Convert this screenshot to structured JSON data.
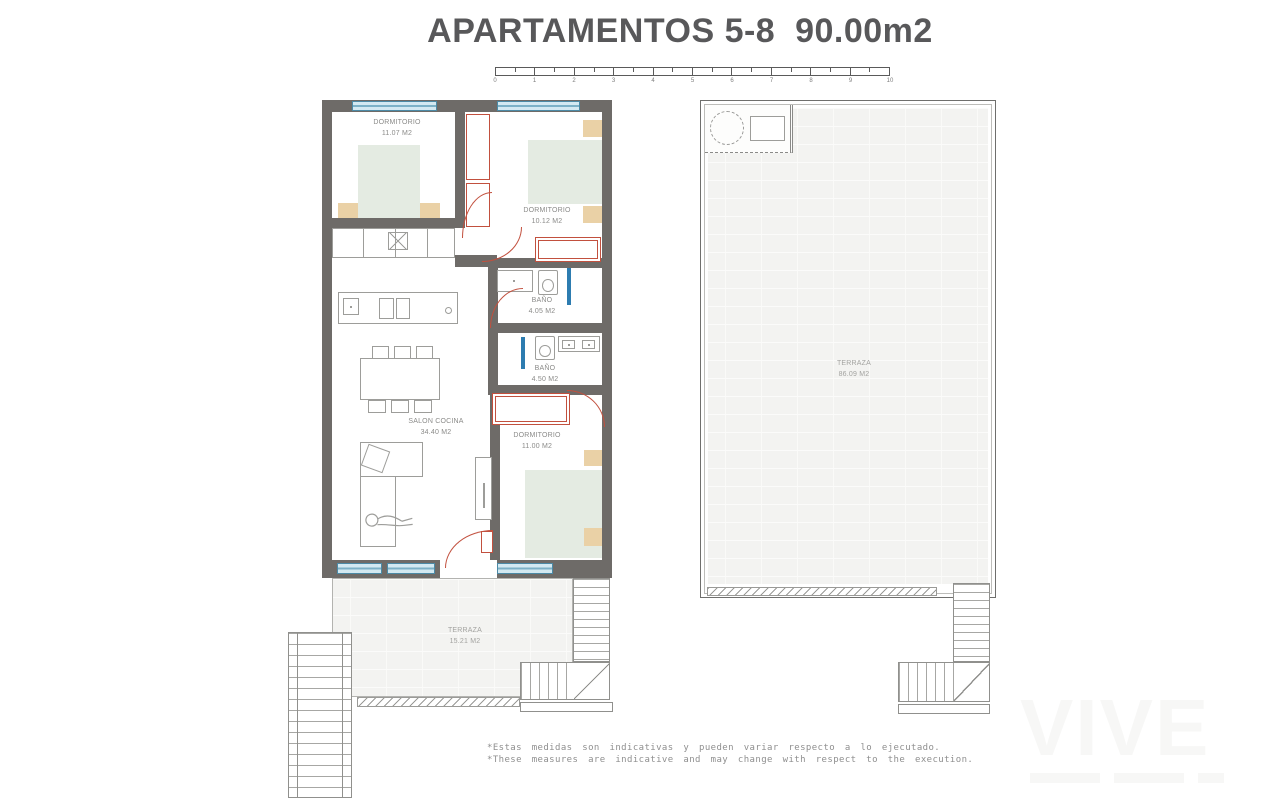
{
  "title": {
    "text": "APARTAMENTOS 5-8  90.00m2"
  },
  "scale_bar": {
    "ticks": [
      "0",
      "1",
      "2",
      "3",
      "4",
      "5",
      "6",
      "7",
      "8",
      "9",
      "10"
    ]
  },
  "rooms": {
    "dorm1": {
      "name": "DORMITORIO",
      "area": "11.07 M2"
    },
    "dorm2": {
      "name": "DORMITORIO",
      "area": "10.12 M2"
    },
    "bano1": {
      "name": "BAÑO",
      "area": "4.05 M2"
    },
    "bano2": {
      "name": "BAÑO",
      "area": "4.50 M2"
    },
    "salon": {
      "name": "SALON COCINA",
      "area": "34.40 M2"
    },
    "dorm3": {
      "name": "DORMITORIO",
      "area": "11.00 M2"
    },
    "terraza_apt": {
      "name": "TERRAZA",
      "area": "15.21 M2"
    },
    "terraza_roof": {
      "name": "TERRAZA",
      "area": "86.09 M2"
    }
  },
  "footnotes": {
    "es": "*Estas medidas son indicativas y pueden variar respecto a lo ejecutado.",
    "en": "*These measures are indicative and may change with respect to the execution."
  },
  "watermark": {
    "text": "VIVE"
  },
  "colors": {
    "wall": "#6e6b68",
    "window_blue": "#7cb1c7",
    "door_red": "#c2503e",
    "bed_green": "#e4ebe2",
    "nightstand_tan": "#ead1a6",
    "shower_blue": "#2d7cb0",
    "terrace_fill": "#f3f3f1",
    "title_gray": "#58585a"
  }
}
